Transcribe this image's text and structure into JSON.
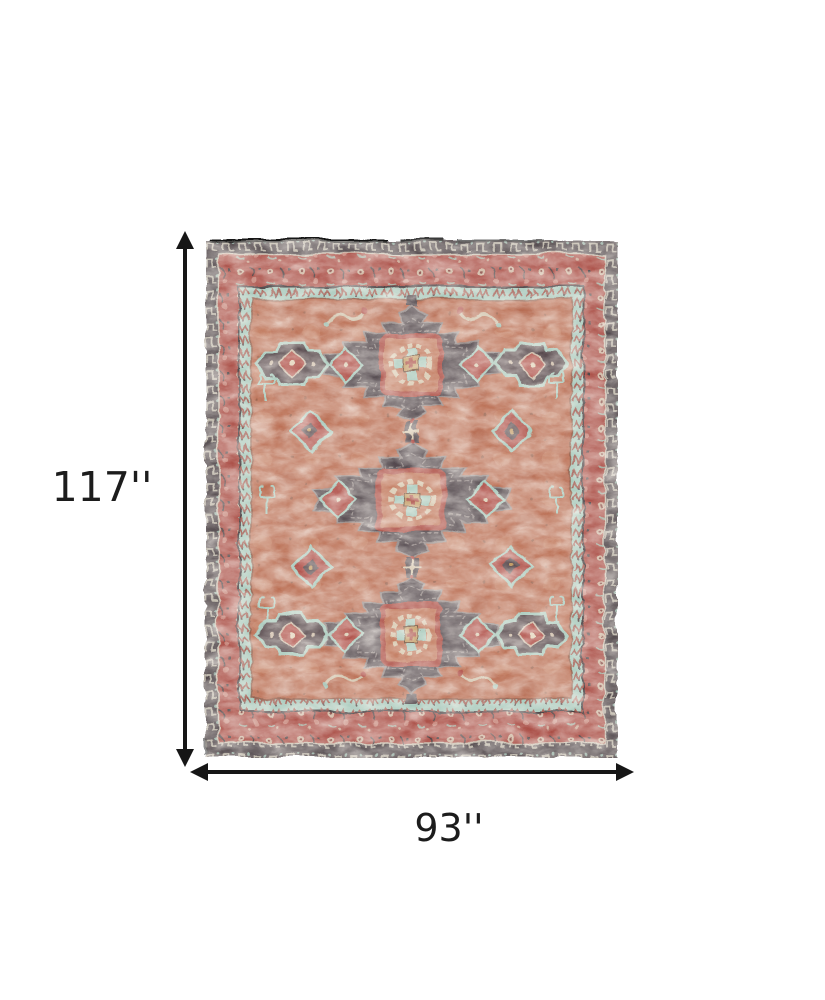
{
  "page": {
    "background_color": "#ffffff"
  },
  "product_image": {
    "alt": "Distressed rust, red and gray persian-style area rug with three dark medallions, shown flat with dimension arrows",
    "rug": {
      "style": "persian-medallion",
      "medallion_count": 3,
      "colors": {
        "field_rust": "#b96c51",
        "band_red": "#a84a42",
        "border_charcoal": "#4c4347",
        "medallion_gray": "#544a4f",
        "accent_teal": "#a4c8bb",
        "accent_cream": "#d4c6ad",
        "accent_gold": "#c29a62",
        "accent_pink": "#c98a7e"
      }
    }
  },
  "dimensions": {
    "height": {
      "label": "117''",
      "value_inches": 117
    },
    "width": {
      "label": "93''",
      "value_inches": 93
    },
    "arrow_color": "#161616",
    "label_color": "#1c1c1c"
  }
}
